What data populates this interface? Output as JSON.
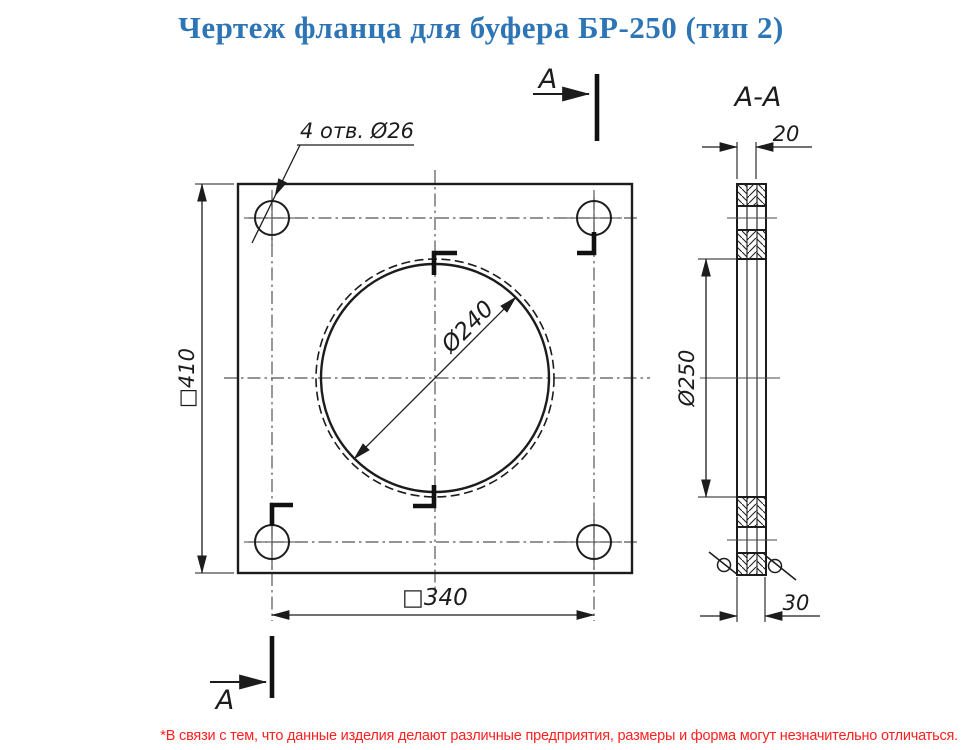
{
  "title": "Чертеж фланца для буфера БР-250 (тип 2)",
  "front_view": {
    "holes_label": "4 отв. Ø26",
    "outer_size": "□410",
    "bolt_spacing": "□340",
    "bore_diameter": "Ø240",
    "section_arrow_top": "А",
    "section_arrow_bottom": "А"
  },
  "section_view": {
    "title": "А-А",
    "plate_thickness": "20",
    "total_thickness": "30",
    "collar_diameter": "Ø250"
  },
  "footnote": "*В связи с тем, что данные изделия делают различные предприятия, размеры и форма могут незначительно отличаться.",
  "colors": {
    "title": "#2e75b6",
    "footnote": "#ff2020",
    "line": "#1c1c1c",
    "centerline": "#555555"
  }
}
